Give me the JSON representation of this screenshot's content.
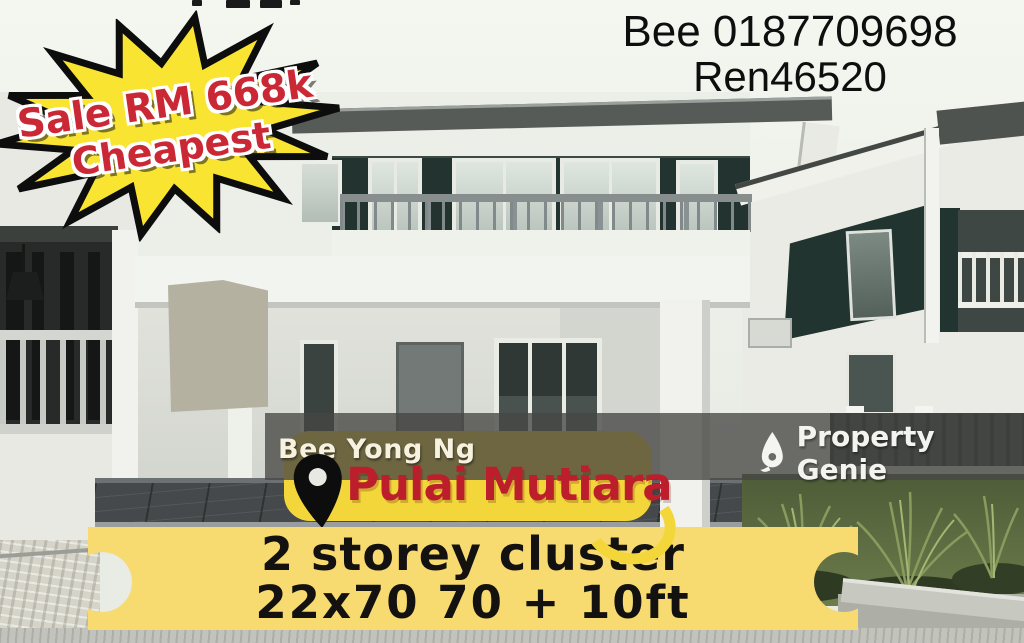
{
  "price_burst": {
    "line1": "Sale RM 668k",
    "line2": "Cheapest"
  },
  "contact": {
    "line1": "Bee 0187709698",
    "line2": "Ren46520"
  },
  "agent_bar": {
    "agent_name": "Bee Yong Ng",
    "brand_name": "Property Genie",
    "brand_icon": "genie-flame-icon"
  },
  "location_badge": {
    "name": "Pulai Mutiara",
    "icon": "location-pin-icon"
  },
  "details_banner": {
    "line1": "2 storey cluster",
    "line2": "22x70 70 + 10ft"
  },
  "colors": {
    "burst_yellow": "#f9e531",
    "burst_text_red": "#cb2836",
    "badge_yellow": "#f3d73a",
    "badge_text_red": "#bd1e2c",
    "banner_yellow": "#f7db70",
    "overlay_bar": "rgba(70,70,68,0.78)",
    "contact_text": "#0e0e0e",
    "house_accent_teal": "#233430"
  }
}
